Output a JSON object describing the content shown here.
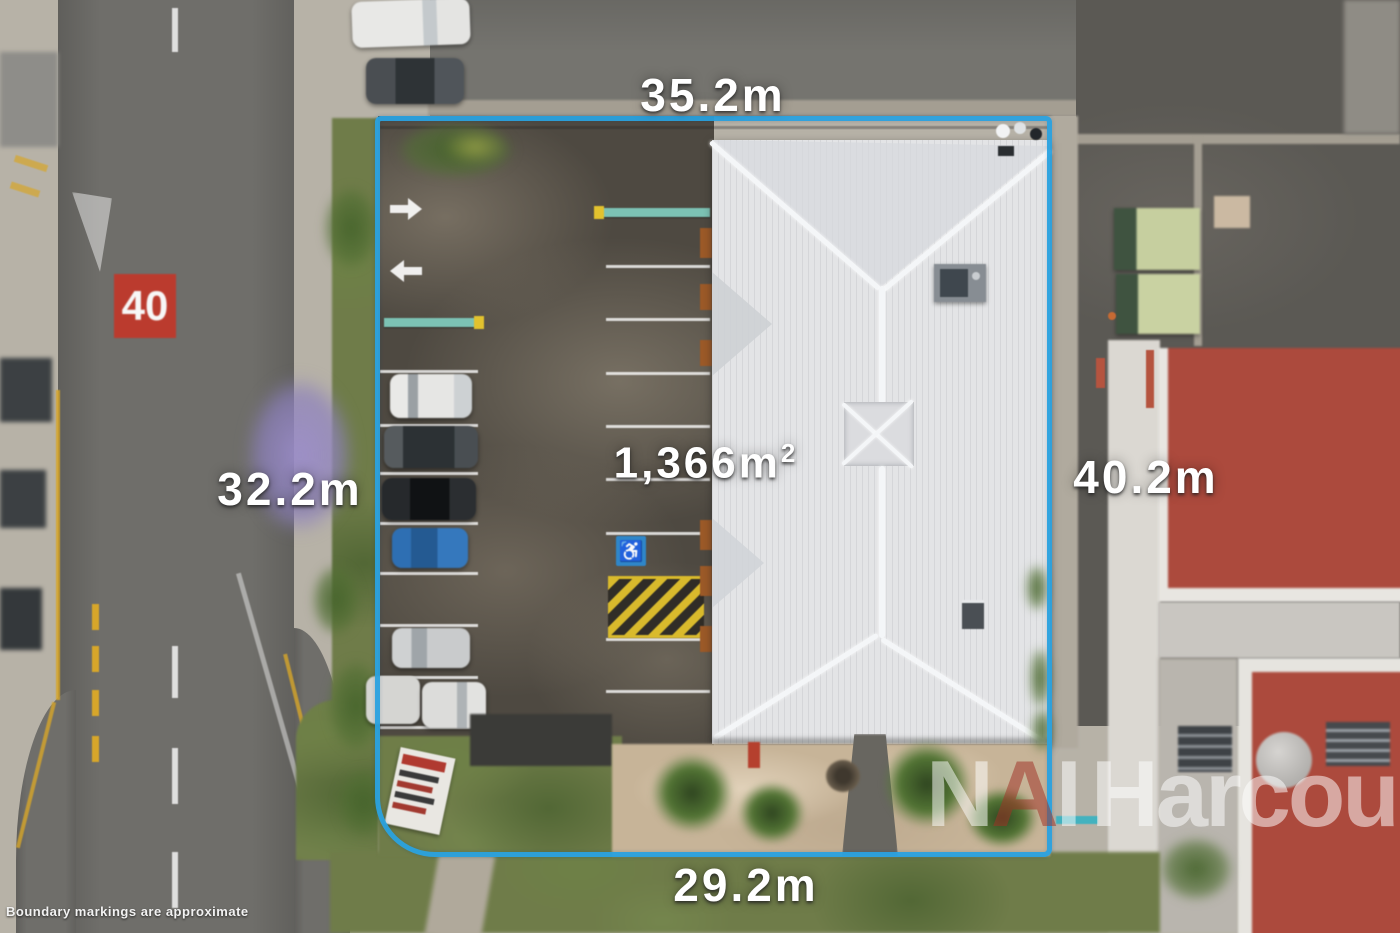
{
  "annotations": {
    "top_measurement": "35.2m",
    "left_measurement": "32.2m",
    "right_measurement": "40.2m",
    "bottom_measurement": "29.2m",
    "area_value": "1,366",
    "area_unit": "m",
    "area_exponent": "2",
    "speed_limit_marking": "40",
    "disclaimer": "Boundary markings are approximate"
  },
  "watermark": {
    "letter_n": "N",
    "letter_a": "A",
    "letter_i": "I",
    "brand": "Harcourts"
  },
  "icons": {
    "accessible_parking": "♿"
  },
  "colors": {
    "boundary_blue": "#2aa2e0",
    "measurement_text": "#ffffff",
    "speed_marking_red": "#c0392b",
    "watermark_red_accent": "#a03226",
    "accessible_blue": "#2f86c8",
    "hazard_yellow": "#d9ba2c",
    "teal_underline": "#2fb3c4"
  }
}
